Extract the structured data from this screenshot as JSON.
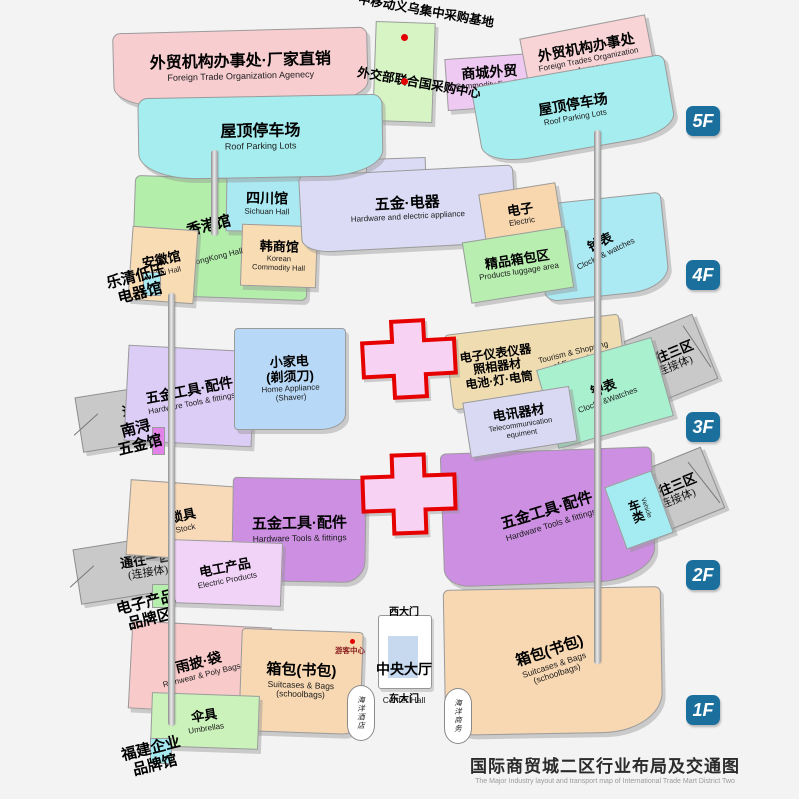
{
  "title": {
    "zh": "国际商贸城二区行业布局及交通图",
    "en": "The Major Industry layout and transport map of International Trade Mart District Two"
  },
  "floor_badges": {
    "f5": "5F",
    "f4": "4F",
    "f3": "3F",
    "f2": "2F",
    "f1": "1F"
  },
  "areas": {
    "ftoa_factory": {
      "zh": "外贸机构办事处·厂家直销",
      "en": "Foreign Trade Organization Agenecy"
    },
    "roof_parking_left": {
      "zh": "屋顶停车场",
      "en": "Roof Parking Lots"
    },
    "commodity_foreign_trades": {
      "zh": "商城外贸",
      "en": "Commodity Foreign Trades"
    },
    "ftoa_right": {
      "zh": "外贸机构办事处",
      "en": "Foreign Trades Organization Agency"
    },
    "roof_parking_right": {
      "zh": "屋顶停车场",
      "en": "Roof Parking Lots"
    },
    "hongkong_hall": {
      "zh": "香港馆",
      "en": "HongKong Hall"
    },
    "sichuan_hall": {
      "zh": "四川馆",
      "en": "Sichuan Hall"
    },
    "korean_hall": {
      "zh": "韩商馆",
      "en": "Korean\nCommodity Hall"
    },
    "anhui_hall": {
      "zh": "安徽馆",
      "en": "Anhui Hall"
    },
    "hardware_electric": {
      "zh": "五金·电器",
      "en": "Hardware and electric appliance"
    },
    "electric_4f": {
      "zh": "电子",
      "en": "Electric"
    },
    "clocks_4f": {
      "zh": "钟表",
      "en": "Clocks & watches"
    },
    "luggage_4f": {
      "zh": "精品箱包区",
      "en": "Products luggage area"
    },
    "hardware_tools_3f": {
      "zh": "五金工具·配件",
      "en": "Hardware Tools & fittings"
    },
    "home_appliance": {
      "zh": "小家电\n(剃须刀)",
      "en": "Home Appliance\n(Shaver)"
    },
    "instruments": {
      "zh": "电子仪表仪器\n照相器材\n电池·灯·电筒",
      "en": "Tourism & Shopping\nof Enterprise"
    },
    "telecom": {
      "zh": "电讯器材",
      "en": "Telecommunication\nequiment"
    },
    "clocks_3f": {
      "zh": "钟表",
      "en": "Clocks &Watches"
    },
    "locks": {
      "zh": "锁具",
      "en": "Stock"
    },
    "electric_products": {
      "zh": "电工产品",
      "en": "Electric Products"
    },
    "hardware_tools_2f_left": {
      "zh": "五金工具·配件",
      "en": "Hardware Tools & fittings"
    },
    "hardware_tools_2f_right": {
      "zh": "五金工具·配件",
      "en": "Hardware Tools & fittings"
    },
    "vehicle": {
      "zh": "车类",
      "en": "Vehicle"
    },
    "rainwear": {
      "zh": "雨披·袋",
      "en": "Rainwear & Poly Bags"
    },
    "umbrellas": {
      "zh": "伞具",
      "en": "Umbrellas"
    },
    "bags_left": {
      "zh": "箱包(书包)",
      "en": "Suitcases & Bags\n(schoolbags)"
    },
    "bags_right": {
      "zh": "箱包(书包)",
      "en": "Suitcases & Bags\n(schoolbags)"
    },
    "center_hall": {
      "zh": "中央大厅",
      "en": "Center Hall"
    }
  },
  "ramps": {
    "to_district1": {
      "zh": "通往一区",
      "sub": "(连接体)"
    },
    "to_district3": {
      "zh": "通往三区",
      "sub": "(连接体)"
    }
  },
  "labels": {
    "china_mobile": "中移动义乌集中采购基地",
    "mofa_un": "外交部联合国采购中心",
    "yueqing": "乐清低压\n电器馆",
    "nanxun": "南浔\n五金馆",
    "electronics_brand": "电子产品\n品牌区",
    "fujian_brand": "福建企业\n品牌馆",
    "west_gate": "西大门",
    "east_gate": "东大门",
    "visitor_center": "游客中心",
    "ocean_hotel": "海洋酒店",
    "ocean_business": "海洋商务"
  },
  "colors": {
    "floor_badge_bg": "#1b6f9d",
    "cross_border": "#e60000",
    "cross_fill": "#f7d2f3",
    "ramp_gray": "#c9c9c9",
    "red_dot": "#e30000",
    "center_hall_inner": "#c6d9ef"
  }
}
